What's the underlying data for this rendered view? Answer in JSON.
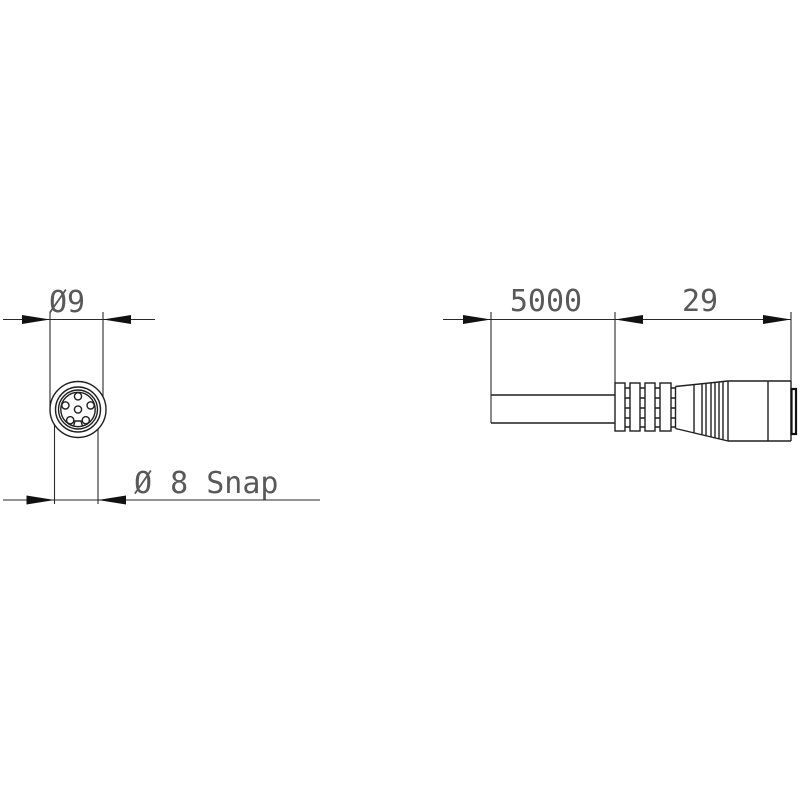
{
  "page": {
    "background_color": "#ffffff"
  },
  "drawing": {
    "line_color": "#1f1f1f",
    "text_color": "#595959",
    "front_view": {
      "top_dimension_label": "Ø9",
      "bottom_dimension_label": "Ø 8 Snap",
      "pin_hole_count": 6
    },
    "side_view": {
      "cable_length_label": "5000",
      "connector_length_label": "29"
    }
  }
}
